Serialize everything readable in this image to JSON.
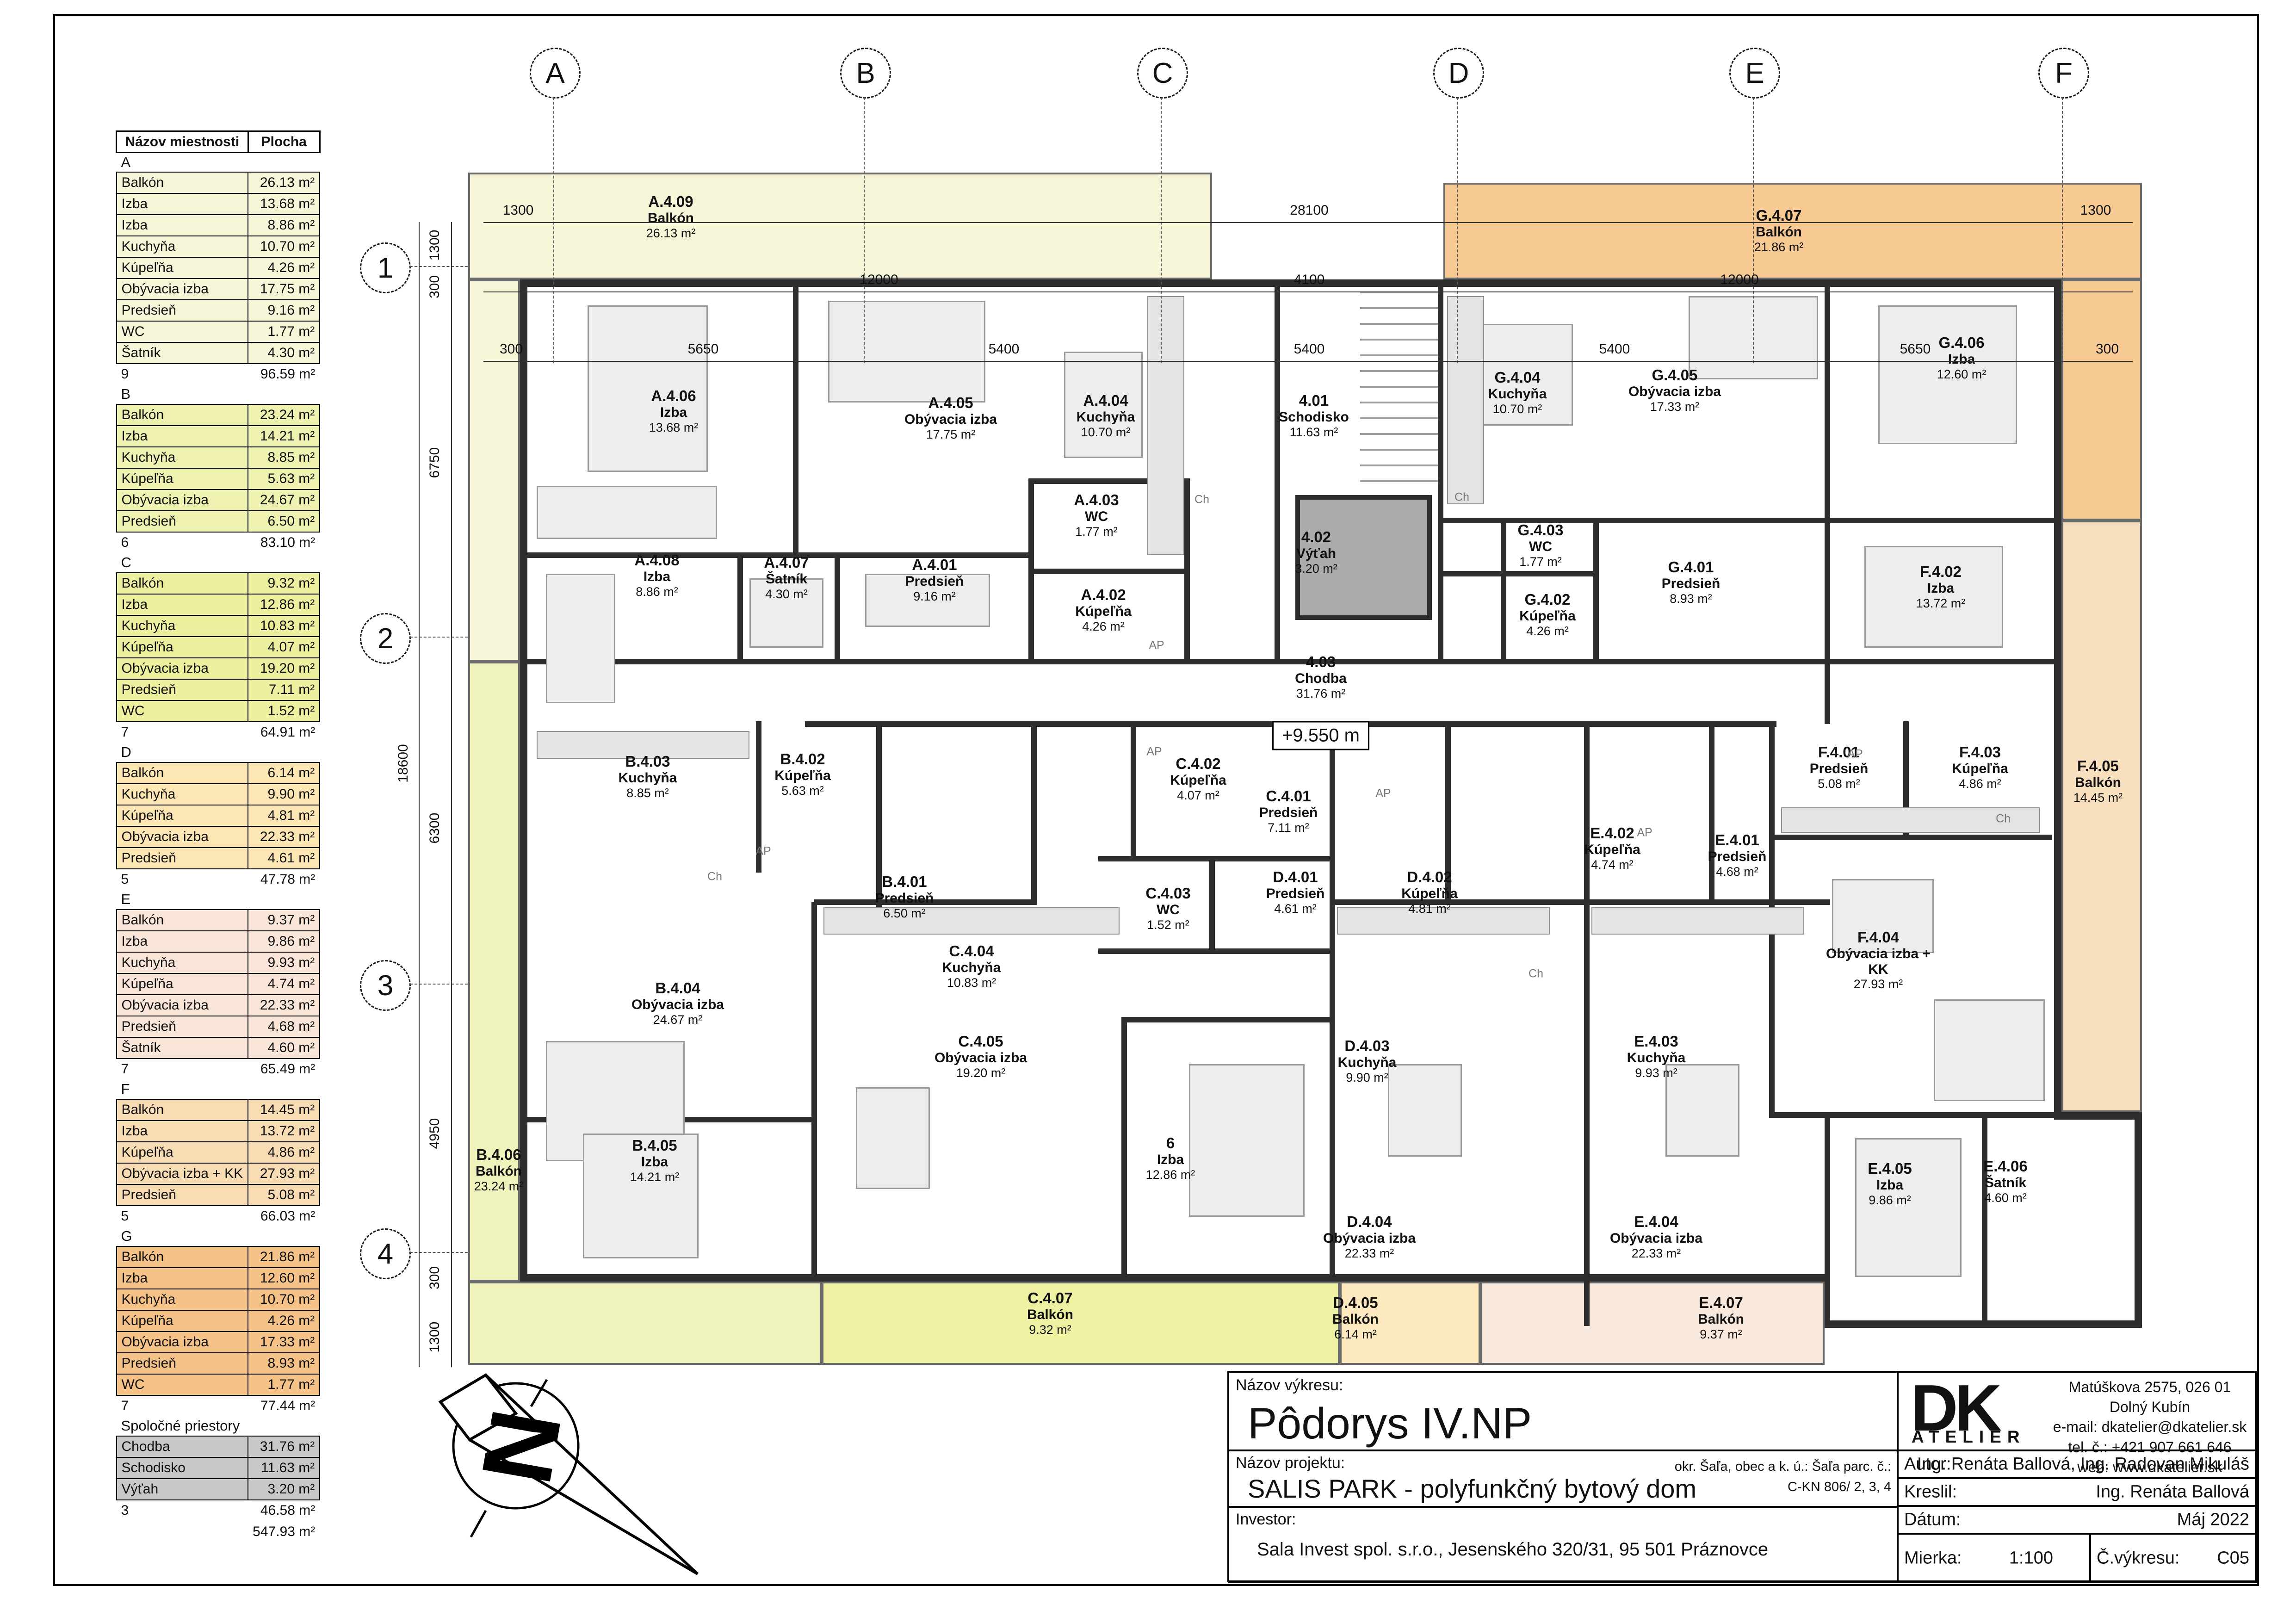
{
  "legend": {
    "header": [
      "Názov miestnosti",
      "Plocha"
    ],
    "sections": [
      {
        "name": "A",
        "count": "9",
        "total": "96.59 m²",
        "rows": [
          [
            "Balkón",
            "26.13 m²"
          ],
          [
            "Izba",
            "13.68 m²"
          ],
          [
            "Izba",
            "8.86 m²"
          ],
          [
            "Kuchyňa",
            "10.70 m²"
          ],
          [
            "Kúpeľňa",
            "4.26 m²"
          ],
          [
            "Obývacia izba",
            "17.75 m²"
          ],
          [
            "Predsieň",
            "9.16 m²"
          ],
          [
            "WC",
            "1.77 m²"
          ],
          [
            "Šatník",
            "4.30 m²"
          ]
        ]
      },
      {
        "name": "B",
        "count": "6",
        "total": "83.10 m²",
        "rows": [
          [
            "Balkón",
            "23.24 m²"
          ],
          [
            "Izba",
            "14.21 m²"
          ],
          [
            "Kuchyňa",
            "8.85 m²"
          ],
          [
            "Kúpeľňa",
            "5.63 m²"
          ],
          [
            "Obývacia izba",
            "24.67 m²"
          ],
          [
            "Predsieň",
            "6.50 m²"
          ]
        ]
      },
      {
        "name": "C",
        "count": "7",
        "total": "64.91 m²",
        "rows": [
          [
            "Balkón",
            "9.32 m²"
          ],
          [
            "Izba",
            "12.86 m²"
          ],
          [
            "Kuchyňa",
            "10.83 m²"
          ],
          [
            "Kúpeľňa",
            "4.07 m²"
          ],
          [
            "Obývacia izba",
            "19.20 m²"
          ],
          [
            "Predsieň",
            "7.11 m²"
          ],
          [
            "WC",
            "1.52 m²"
          ]
        ]
      },
      {
        "name": "D",
        "count": "5",
        "total": "47.78 m²",
        "rows": [
          [
            "Balkón",
            "6.14 m²"
          ],
          [
            "Kuchyňa",
            "9.90 m²"
          ],
          [
            "Kúpeľňa",
            "4.81 m²"
          ],
          [
            "Obývacia izba",
            "22.33 m²"
          ],
          [
            "Predsieň",
            "4.61 m²"
          ]
        ]
      },
      {
        "name": "E",
        "count": "7",
        "total": "65.49 m²",
        "rows": [
          [
            "Balkón",
            "9.37 m²"
          ],
          [
            "Izba",
            "9.86 m²"
          ],
          [
            "Kuchyňa",
            "9.93 m²"
          ],
          [
            "Kúpeľňa",
            "4.74 m²"
          ],
          [
            "Obývacia izba",
            "22.33 m²"
          ],
          [
            "Predsieň",
            "4.68 m²"
          ],
          [
            "Šatník",
            "4.60 m²"
          ]
        ]
      },
      {
        "name": "F",
        "count": "5",
        "total": "66.03 m²",
        "rows": [
          [
            "Balkón",
            "14.45 m²"
          ],
          [
            "Izba",
            "13.72 m²"
          ],
          [
            "Kúpeľňa",
            "4.86 m²"
          ],
          [
            "Obývacia izba + KK",
            "27.93 m²"
          ],
          [
            "Predsieň",
            "5.08 m²"
          ]
        ]
      },
      {
        "name": "G",
        "count": "7",
        "total": "77.44 m²",
        "rows": [
          [
            "Balkón",
            "21.86 m²"
          ],
          [
            "Izba",
            "12.60 m²"
          ],
          [
            "Kuchyňa",
            "10.70 m²"
          ],
          [
            "Kúpeľňa",
            "4.26 m²"
          ],
          [
            "Obývacia izba",
            "17.33 m²"
          ],
          [
            "Predsieň",
            "8.93 m²"
          ],
          [
            "WC",
            "1.77 m²"
          ]
        ]
      },
      {
        "name": "Spoločné priestory",
        "count": "3",
        "total": "46.58 m²",
        "rows": [
          [
            "Chodba",
            "31.76 m²"
          ],
          [
            "Schodisko",
            "11.63 m²"
          ],
          [
            "Výťah",
            "3.20 m²"
          ]
        ]
      }
    ],
    "grand_total": "547.93 m²"
  },
  "grid": {
    "cols": [
      "A",
      "B",
      "C",
      "D",
      "E",
      "F"
    ],
    "rows": [
      "1",
      "2",
      "3",
      "4"
    ],
    "dims_row1": [
      "1300",
      "28100",
      "1300"
    ],
    "dims_row2": [
      "12000",
      "4100",
      "12000"
    ],
    "dims_row3": [
      "300",
      "5650",
      "5400",
      "5400",
      "5400",
      "5650",
      "300"
    ],
    "dims_left": [
      "1300",
      "300",
      "6750",
      "6300",
      "4950",
      "300",
      "1300"
    ],
    "dims_left_total": "18600"
  },
  "plan": {
    "elevation": "+9.550 m",
    "appliance_ch": "Ch",
    "appliance_ap": "AP",
    "rooms": [
      {
        "id": "A.4.09",
        "name": "Balkón",
        "area": "26.13 m²"
      },
      {
        "id": "A.4.06",
        "name": "Izba",
        "area": "13.68 m²"
      },
      {
        "id": "A.4.05",
        "name": "Obývacia izba",
        "area": "17.75 m²"
      },
      {
        "id": "A.4.04",
        "name": "Kuchyňa",
        "area": "10.70 m²"
      },
      {
        "id": "A.4.08",
        "name": "Izba",
        "area": "8.86 m²"
      },
      {
        "id": "A.4.07",
        "name": "Šatník",
        "area": "4.30 m²"
      },
      {
        "id": "A.4.01",
        "name": "Predsieň",
        "area": "9.16 m²"
      },
      {
        "id": "A.4.03",
        "name": "WC",
        "area": "1.77 m²"
      },
      {
        "id": "A.4.02",
        "name": "Kúpeľňa",
        "area": "4.26 m²"
      },
      {
        "id": "4.01",
        "name": "Schodisko",
        "area": "11.63 m²"
      },
      {
        "id": "4.02",
        "name": "Výťah",
        "area": "3.20 m²"
      },
      {
        "id": "4.03",
        "name": "Chodba",
        "area": "31.76 m²"
      },
      {
        "id": "G.4.07",
        "name": "Balkón",
        "area": "21.86 m²"
      },
      {
        "id": "G.4.04",
        "name": "Kuchyňa",
        "area": "10.70 m²"
      },
      {
        "id": "G.4.05",
        "name": "Obývacia izba",
        "area": "17.33 m²"
      },
      {
        "id": "G.4.06",
        "name": "Izba",
        "area": "12.60 m²"
      },
      {
        "id": "G.4.03",
        "name": "WC",
        "area": "1.77 m²"
      },
      {
        "id": "G.4.02",
        "name": "Kúpeľňa",
        "area": "4.26 m²"
      },
      {
        "id": "G.4.01",
        "name": "Predsieň",
        "area": "8.93 m²"
      },
      {
        "id": "F.4.02",
        "name": "Izba",
        "area": "13.72 m²"
      },
      {
        "id": "F.4.01",
        "name": "Predsieň",
        "area": "5.08 m²"
      },
      {
        "id": "F.4.03",
        "name": "Kúpeľňa",
        "area": "4.86 m²"
      },
      {
        "id": "F.4.04",
        "name": "Obývacia izba + KK",
        "area": "27.93 m²"
      },
      {
        "id": "F.4.05",
        "name": "Balkón",
        "area": "14.45 m²"
      },
      {
        "id": "B.4.03",
        "name": "Kuchyňa",
        "area": "8.85 m²"
      },
      {
        "id": "B.4.02",
        "name": "Kúpeľňa",
        "area": "5.63 m²"
      },
      {
        "id": "B.4.01",
        "name": "Predsieň",
        "area": "6.50 m²"
      },
      {
        "id": "B.4.04",
        "name": "Obývacia izba",
        "area": "24.67 m²"
      },
      {
        "id": "B.4.05",
        "name": "Izba",
        "area": "14.21 m²"
      },
      {
        "id": "B.4.06",
        "name": "Balkón",
        "area": "23.24 m²"
      },
      {
        "id": "C.4.02",
        "name": "Kúpeľňa",
        "area": "4.07 m²"
      },
      {
        "id": "C.4.01",
        "name": "Predsieň",
        "area": "7.11 m²"
      },
      {
        "id": "C.4.03",
        "name": "WC",
        "area": "1.52 m²"
      },
      {
        "id": "C.4.04",
        "name": "Kuchyňa",
        "area": "10.83 m²"
      },
      {
        "id": "C.4.05",
        "name": "Obývacia izba",
        "area": "19.20 m²"
      },
      {
        "id": "6",
        "name": "Izba",
        "area": "12.86 m²"
      },
      {
        "id": "C.4.07",
        "name": "Balkón",
        "area": "9.32 m²"
      },
      {
        "id": "D.4.01",
        "name": "Predsieň",
        "area": "4.61 m²"
      },
      {
        "id": "D.4.02",
        "name": "Kúpeľňa",
        "area": "4.81 m²"
      },
      {
        "id": "D.4.03",
        "name": "Kuchyňa",
        "area": "9.90 m²"
      },
      {
        "id": "D.4.04",
        "name": "Obývacia izba",
        "area": "22.33 m²"
      },
      {
        "id": "D.4.05",
        "name": "Balkón",
        "area": "6.14 m²"
      },
      {
        "id": "E.4.02",
        "name": "Kúpeľňa",
        "area": "4.74 m²"
      },
      {
        "id": "E.4.01",
        "name": "Predsieň",
        "area": "4.68 m²"
      },
      {
        "id": "E.4.03",
        "name": "Kuchyňa",
        "area": "9.93 m²"
      },
      {
        "id": "E.4.04",
        "name": "Obývacia izba",
        "area": "22.33 m²"
      },
      {
        "id": "E.4.05",
        "name": "Izba",
        "area": "9.86 m²"
      },
      {
        "id": "E.4.06",
        "name": "Šatník",
        "area": "4.60 m²"
      },
      {
        "id": "E.4.07",
        "name": "Balkón",
        "area": "9.37 m²"
      }
    ]
  },
  "titleblock": {
    "drawing_label": "Názov výkresu:",
    "drawing_title": "Pôdorys IV.NP",
    "project_label": "Názov projektu:",
    "project_title": "SALIS PARK - polyfunkčný bytový dom",
    "location_line1": "okr. Šaľa, obec a k. ú.: Šaľa parc. č.:",
    "location_line2": "C-KN 806/ 2, 3, 4",
    "investor_label": "Investor:",
    "investor": "Sala Invest spol. s.r.o., Jesenského 320/31, 95 501 Práznovce",
    "logo": "DK",
    "logo_sub": "ATELIÉR",
    "addr1": "Matúškova 2575, 026 01 Dolný Kubín",
    "addr2": "e-mail: dkatelier@dkatelier.sk",
    "addr3": "tel. č.: +421 907 661 646",
    "addr4": "web: www.dkatelier.sk",
    "autor_label": "Autor:",
    "autor": "Ing. Renáta Ballová, Ing. Radovan Mikuláš",
    "kreslil_label": "Kreslil:",
    "kreslil": "Ing. Renáta Ballová",
    "datum_label": "Dátum:",
    "datum": "Máj 2022",
    "mierka_label": "Mierka:",
    "mierka": "1:100",
    "cislo_label": "Č.výkresu:",
    "cislo": "C05"
  }
}
